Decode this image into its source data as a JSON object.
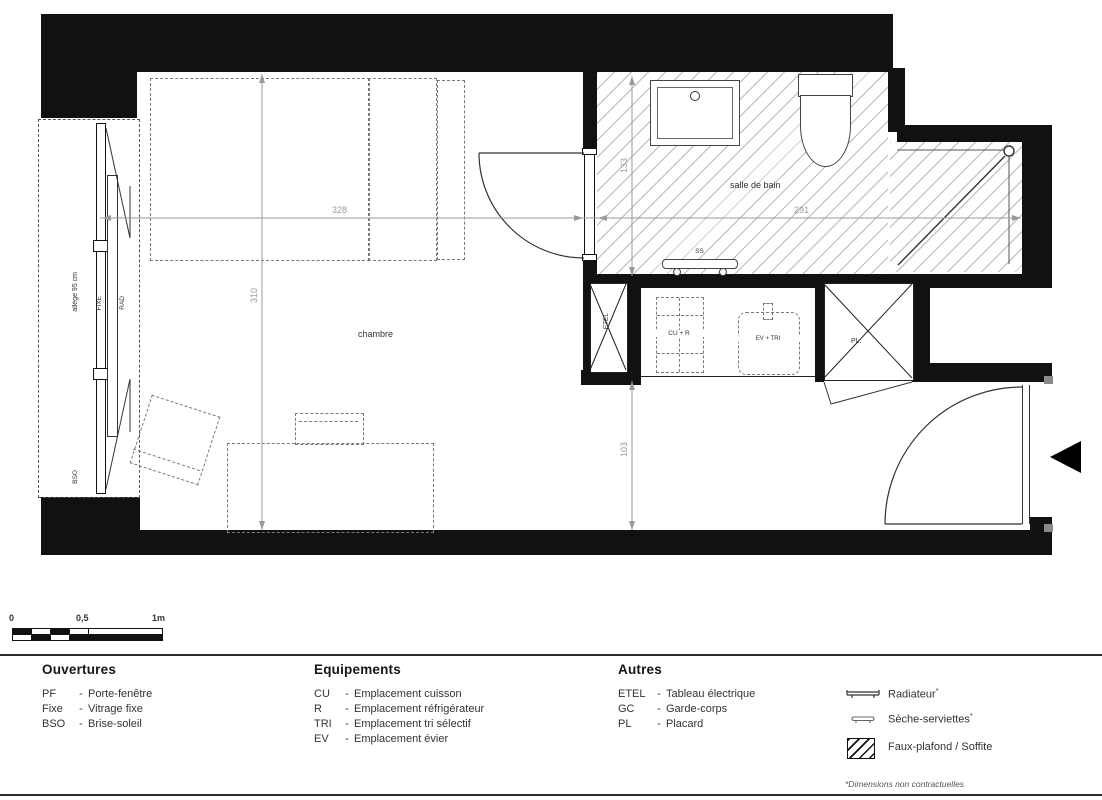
{
  "plan": {
    "rooms": {
      "bedroom": "chambre",
      "bathroom": "salle de bain"
    },
    "dimensions": {
      "bedroom_width": "328",
      "bedroom_depth": "310",
      "bathroom_width": "291",
      "bathroom_depth": "133",
      "entry_depth": "103"
    },
    "labels": {
      "window_sill": "allège 95 cm",
      "fixed_glazing": "FIXE",
      "radiator": "RAD",
      "brise_soleil": "BSO",
      "electrical_panel": "ETEL",
      "cooking_fridge": "CU + R",
      "sink_sorting": "EV + TRI",
      "closet": "PL.",
      "towel_dryer": "SS"
    }
  },
  "scale_bar": {
    "tick_0": "0",
    "tick_half": "0,5",
    "tick_1": "1m"
  },
  "legend": {
    "openings": {
      "title": "Ouvertures",
      "items": [
        {
          "abbr": "PF",
          "sep": "-",
          "label": "Porte-fenêtre"
        },
        {
          "abbr": "Fixe",
          "sep": "-",
          "label": "Vitrage fixe"
        },
        {
          "abbr": "BSO",
          "sep": "-",
          "label": "Brise-soleil"
        }
      ]
    },
    "equipment": {
      "title": "Equipements",
      "items": [
        {
          "abbr": "CU",
          "sep": "-",
          "label": "Emplacement cuisson"
        },
        {
          "abbr": "R",
          "sep": "-",
          "label": "Emplacement réfrigérateur"
        },
        {
          "abbr": "TRI",
          "sep": "-",
          "label": "Emplacement tri sélectif"
        },
        {
          "abbr": "EV",
          "sep": "-",
          "label": "Emplacement évier"
        }
      ]
    },
    "others": {
      "title": "Autres",
      "items": [
        {
          "abbr": "ETEL",
          "sep": "-",
          "label": "Tableau électrique"
        },
        {
          "abbr": "GC",
          "sep": "-",
          "label": "Garde-corps"
        },
        {
          "abbr": "PL",
          "sep": "-",
          "label": "Placard"
        }
      ]
    },
    "symbols": {
      "radiator": {
        "label": "Radiateur",
        "mark": "*"
      },
      "towel_dryer": {
        "label": "Sèche-serviettes",
        "mark": "*"
      },
      "false_ceiling": {
        "label": "Faux-plafond / Soffite",
        "mark": ""
      }
    },
    "footnote": "*Dimensions non contractuelles"
  },
  "colors": {
    "wall": "#111111",
    "hatch": "#b9b9b9",
    "dimension": "#9a9a9a",
    "furniture_dash": "#7a7a7a"
  }
}
